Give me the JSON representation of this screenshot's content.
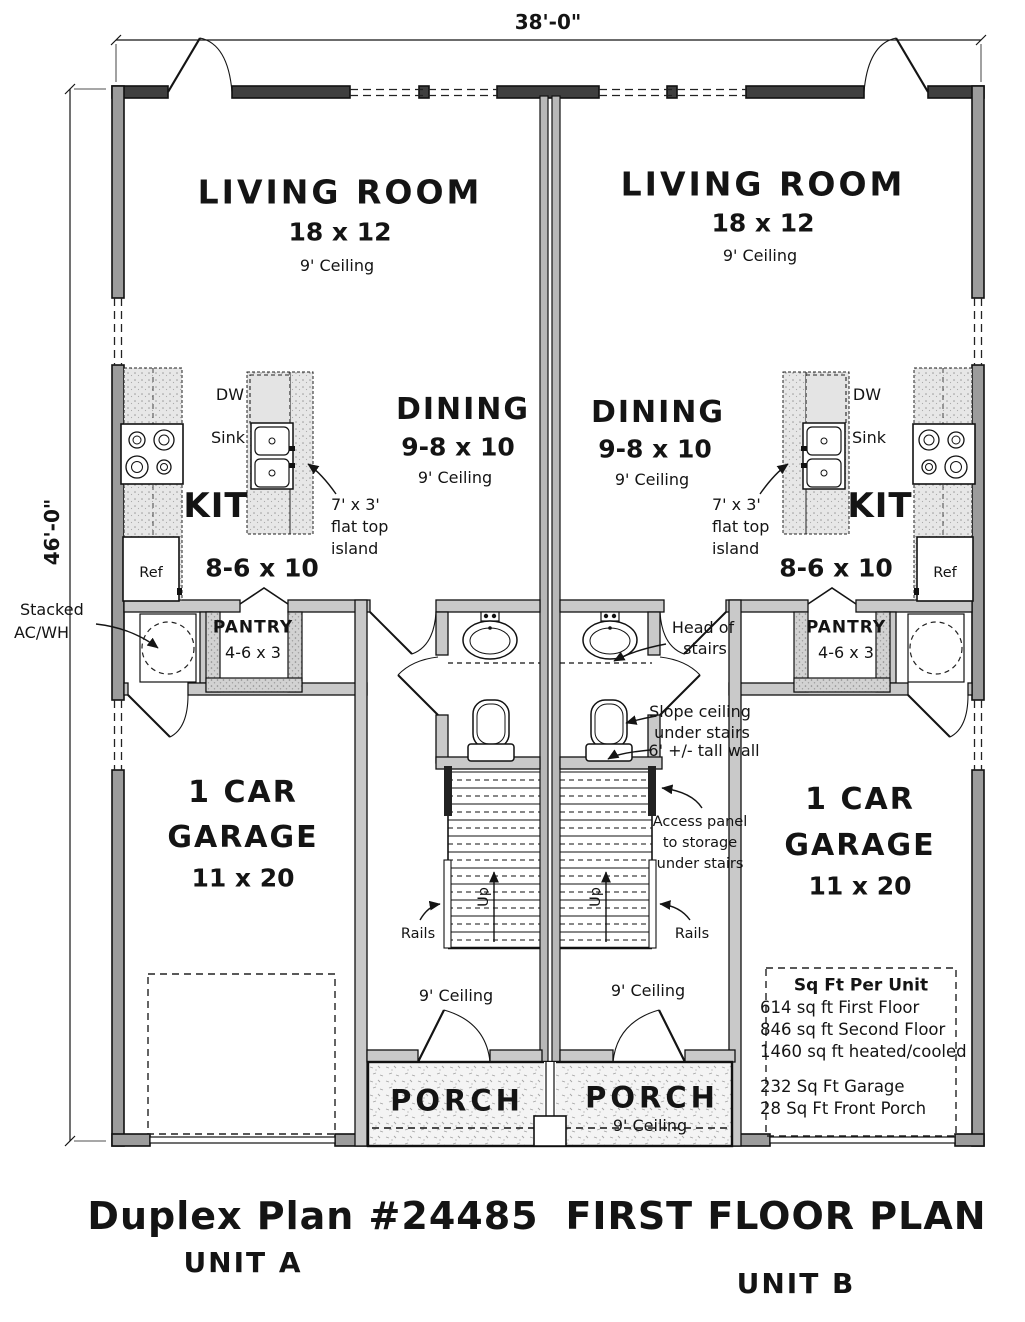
{
  "dimensions": {
    "width": "38'-0\"",
    "height": "46'-0\""
  },
  "unit_a": {
    "living": {
      "name": "LIVING ROOM",
      "size": "18 x 12",
      "ceiling": "9' Ceiling"
    },
    "dining": {
      "name": "DINING",
      "size": "9-8 x 10",
      "ceiling": "9' Ceiling"
    },
    "kitchen": {
      "name": "KIT",
      "size": "8-6 x 10",
      "dw": "DW",
      "sink": "Sink",
      "ref": "Ref",
      "island_lines": [
        "7' x 3'",
        "flat top",
        "island"
      ]
    },
    "pantry": {
      "name": "PANTRY",
      "size": "4-6 x 3"
    },
    "garage": {
      "line1": "1 CAR",
      "line2": "GARAGE",
      "size": "11 x 20"
    },
    "porch": {
      "name": "PORCH"
    },
    "hall_ceiling": "9' Ceiling",
    "up": "Up",
    "rails": "Rails"
  },
  "unit_b": {
    "living": {
      "name": "LIVING ROOM",
      "size": "18 x 12",
      "ceiling": "9' Ceiling"
    },
    "dining": {
      "name": "DINING",
      "size": "9-8 x 10",
      "ceiling": "9' Ceiling"
    },
    "kitchen": {
      "name": "KIT",
      "size": "8-6 x 10",
      "dw": "DW",
      "sink": "Sink",
      "ref": "Ref",
      "island_lines": [
        "7' x 3'",
        "flat top",
        "island"
      ]
    },
    "pantry": {
      "name": "PANTRY",
      "size": "4-6 x 3"
    },
    "garage": {
      "line1": "1 CAR",
      "line2": "GARAGE",
      "size": "11 x 20"
    },
    "porch": {
      "name": "PORCH",
      "ceiling": "9' Ceiling"
    },
    "hall_ceiling": "9' Ceiling",
    "up": "Up",
    "rails": "Rails"
  },
  "annotations": {
    "stacked_ac_line1": "Stacked",
    "stacked_ac_line2": "AC/WH",
    "head_line1": "Head of",
    "head_line2": "stairs",
    "slope_line1": "Slope ceiling",
    "slope_line2": "under stairs",
    "tall_wall": "6' +/- tall wall",
    "access_line1": "Access panel",
    "access_line2": "to storage",
    "access_line3": "under stairs"
  },
  "sqft": {
    "title": "Sq Ft Per Unit",
    "lines": [
      "614 sq ft First Floor",
      "846 sq ft Second Floor",
      "1460 sq ft heated/cooled",
      "232 Sq Ft Garage",
      "28 Sq Ft Front Porch"
    ]
  },
  "footer": {
    "plan_title": "Duplex Plan #24485",
    "drawing_title": "FIRST FLOOR PLAN",
    "unit_a": "UNIT A",
    "unit_b": "UNIT B"
  }
}
